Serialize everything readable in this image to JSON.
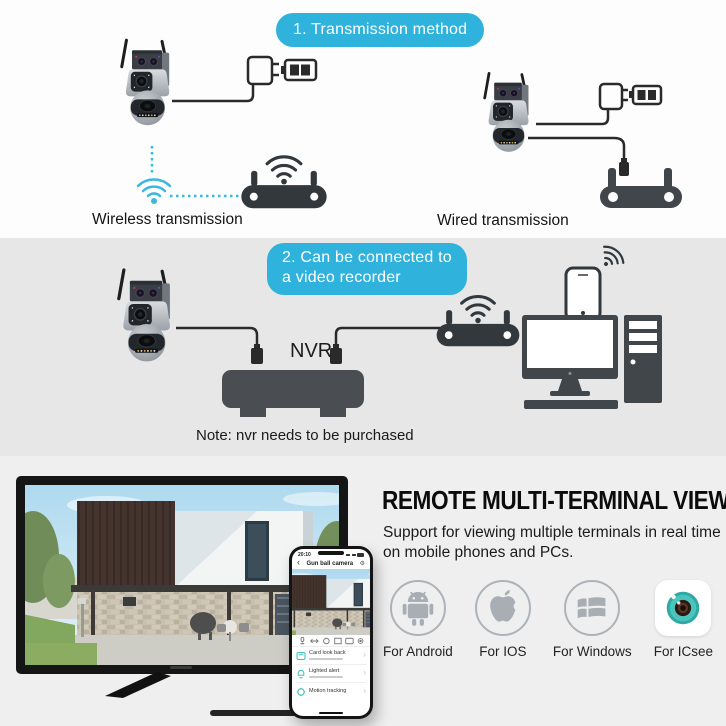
{
  "banner1": {
    "text": "1. Transmission method"
  },
  "banner2": {
    "line1": "2. Can be connected to",
    "line2": "a video recorder"
  },
  "transmission": {
    "wireless_label": "Wireless transmission",
    "wired_label": "Wired transmission"
  },
  "nvr": {
    "label": "NVR",
    "note": "Note: nvr needs to be purchased"
  },
  "remote_view": {
    "title": "REMOTE MULTI-TERMINAL VIEW",
    "subtitle": "Support for viewing multiple terminals in real time on mobile phones and PCs.",
    "platforms": [
      {
        "label": "For Android",
        "icon": "android-icon"
      },
      {
        "label": "For IOS",
        "icon": "apple-icon"
      },
      {
        "label": "For Windows",
        "icon": "windows-icon"
      },
      {
        "label": "For ICsee",
        "icon": "icsee-icon"
      }
    ]
  },
  "phone_app": {
    "time": "20:10",
    "title": "Gun ball camera",
    "back_icon": "‹",
    "gear_icon": "⚙",
    "forward_icon": "›",
    "features": [
      {
        "name": "Card look back"
      },
      {
        "name": "Lighted alert"
      },
      {
        "name": "Motion tracking"
      }
    ]
  },
  "colors": {
    "banner_bg": "#2fb3dc",
    "teal_accent": "#3ab8dd",
    "icsee_teal": "#3fbfb9",
    "platform_icon_gray": "#a8aeb4",
    "device_dark": "#33383c"
  }
}
